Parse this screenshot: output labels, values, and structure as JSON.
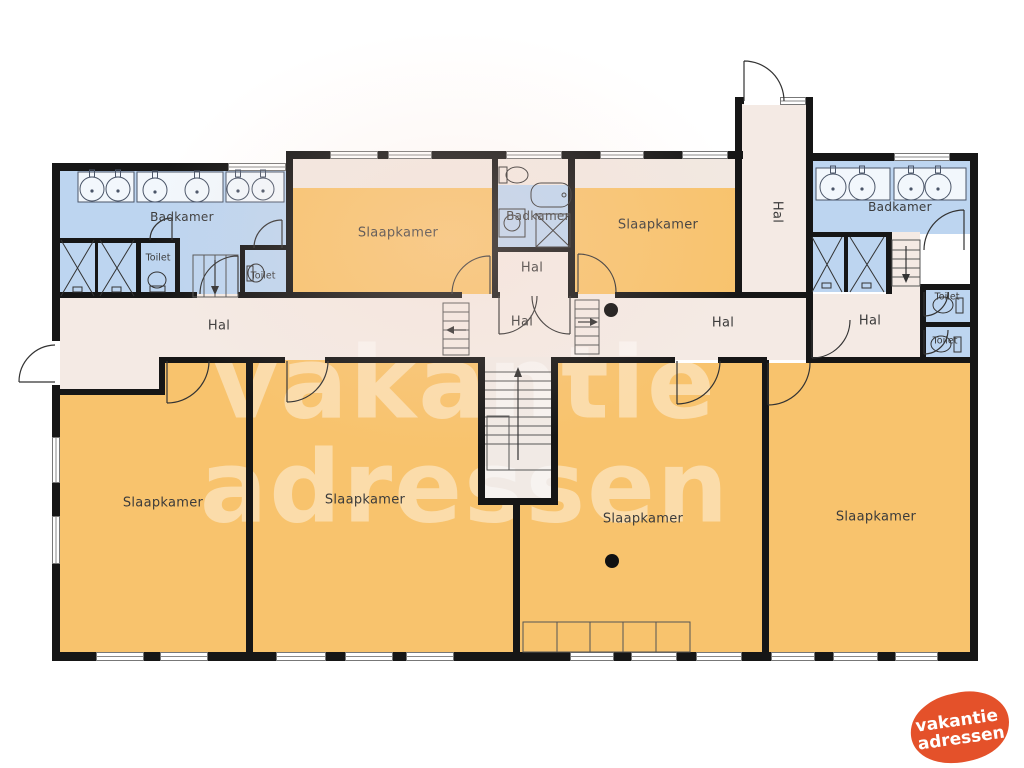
{
  "plan_title": "floorplan",
  "colors": {
    "room": "#f8c36d",
    "bath": "#bdd5f0",
    "hall": "#f4eae4",
    "wall": "#161616",
    "logo": "#e4512a"
  },
  "rooms": {
    "badkamer_left": "Badkamer",
    "toilet_left_1": "Toilet",
    "toilet_left_2": "Toilet",
    "slaapkamer_top_left": "Slaapkamer",
    "badkamer_center": "Badkamer",
    "hal_center_small": "Hal",
    "slaapkamer_top_right": "Slaapkamer",
    "hal_vertical": "Hal",
    "badkamer_right": "Badkamer",
    "toilet_right_1": "Toilet",
    "toilet_right_2": "Toilet",
    "hal_right": "Hal",
    "hal_left": "Hal",
    "hal_center": "Hal",
    "hal_right_mid": "Hal",
    "slaapkamer_bottom_1": "Slaapkamer",
    "slaapkamer_bottom_2": "Slaapkamer",
    "slaapkamer_bottom_3": "Slaapkamer",
    "slaapkamer_bottom_4": "Slaapkamer"
  },
  "watermark": {
    "line1": "vakantie",
    "line2": "adressen"
  },
  "logo": {
    "line1": "vakantie",
    "line2": "adressen"
  }
}
